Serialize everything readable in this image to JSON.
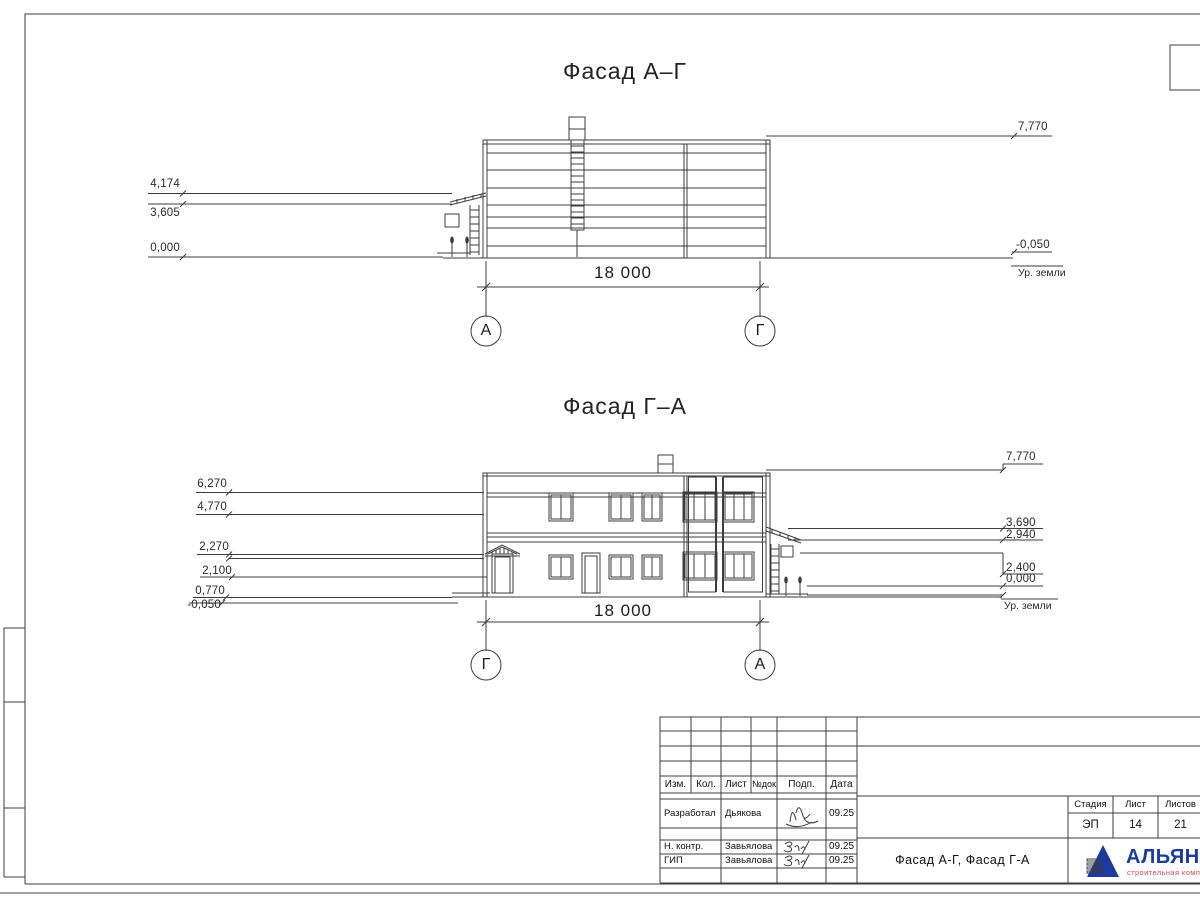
{
  "facade1": {
    "title": "Фасад А–Г",
    "dimension": "18 000",
    "axis_left": "А",
    "axis_right": "Г",
    "marks_left": [
      "4,174",
      "3,605",
      "0,000"
    ],
    "marks_right": [
      "7,770",
      "-0,050"
    ],
    "ground_label": "Ур. земли"
  },
  "facade2": {
    "title": "Фасад Г–А",
    "dimension": "18 000",
    "axis_left": "Г",
    "axis_right": "А",
    "marks_left": [
      "6,270",
      "4,770",
      "2,270",
      "2,100",
      "0,770",
      "-0,050"
    ],
    "marks_right": [
      "7,770",
      "3,690",
      "2,940",
      "2,400",
      "0,000"
    ],
    "ground_label": "Ур. земли"
  },
  "title_block": {
    "header_cols": [
      "Изм.",
      "Кол.",
      "Лист",
      "№док",
      "Подп.",
      "Дата"
    ],
    "rows": [
      {
        "role": "Разработал",
        "name": "Дьякова",
        "date": "09.25"
      },
      {
        "role": "Н. контр.",
        "name": "Завьялова",
        "date": "09.25"
      },
      {
        "role": "ГИП",
        "name": "Завьялова",
        "date": "09.25"
      }
    ],
    "doc_title": "Фасад А-Г, Фасад Г-А",
    "stage_label": "Стадия",
    "sheet_label": "Лист",
    "sheets_label": "Листов",
    "stage": "ЭП",
    "sheet_no": "14",
    "sheets_total": "21",
    "company_name": "АЛЬЯНС",
    "company_tagline": "строительная компания",
    "colors": {
      "brand_blue": "#1d3a9e",
      "brand_red": "#cf4a4a"
    }
  }
}
